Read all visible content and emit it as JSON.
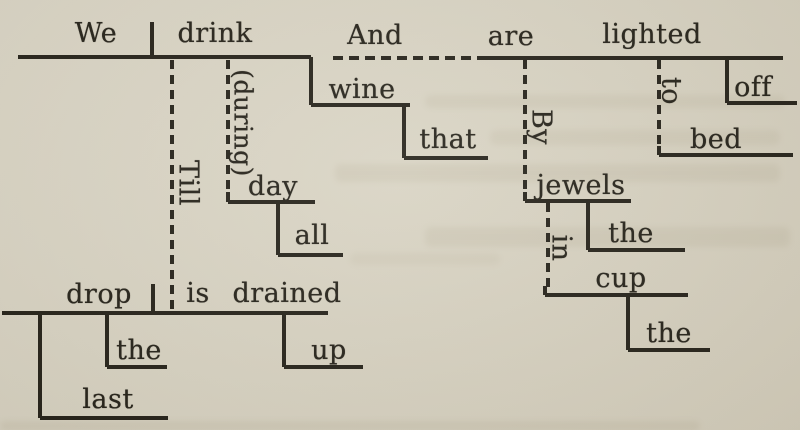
{
  "page": {
    "background": "#d8d3c3",
    "ink": "#221f17",
    "description": "Reed-Kellogg sentence diagram: We drink wine that all day (during), Till the last drop is drained up, And are lighted off to bed By the jewels in the cup."
  },
  "diagram": {
    "words": [
      {
        "id": "we",
        "text": "We",
        "x": 96,
        "y": 34,
        "rotated": false
      },
      {
        "id": "drink",
        "text": "drink",
        "x": 215,
        "y": 34,
        "rotated": false
      },
      {
        "id": "and",
        "text": "And",
        "x": 375,
        "y": 36,
        "rotated": false
      },
      {
        "id": "are",
        "text": "are",
        "x": 511,
        "y": 37,
        "rotated": false
      },
      {
        "id": "lighted",
        "text": "lighted",
        "x": 652,
        "y": 35,
        "rotated": false
      },
      {
        "id": "wine",
        "text": "wine",
        "x": 362,
        "y": 90,
        "rotated": false
      },
      {
        "id": "that",
        "text": "that",
        "x": 448,
        "y": 140,
        "rotated": false
      },
      {
        "id": "by",
        "text": "By",
        "x": 541,
        "y": 127,
        "rotated": true
      },
      {
        "id": "to",
        "text": "to",
        "x": 671,
        "y": 91,
        "rotated": true
      },
      {
        "id": "off",
        "text": "off",
        "x": 753,
        "y": 88,
        "rotated": false
      },
      {
        "id": "bed",
        "text": "bed",
        "x": 716,
        "y": 140,
        "rotated": false
      },
      {
        "id": "jewels",
        "text": "jewels",
        "x": 581,
        "y": 186,
        "rotated": false
      },
      {
        "id": "the-jewels",
        "text": "the",
        "x": 631,
        "y": 234,
        "rotated": false
      },
      {
        "id": "in",
        "text": "in",
        "x": 561,
        "y": 248,
        "rotated": true
      },
      {
        "id": "cup",
        "text": "cup",
        "x": 621,
        "y": 279,
        "rotated": false
      },
      {
        "id": "the-cup",
        "text": "the",
        "x": 669,
        "y": 334,
        "rotated": false
      },
      {
        "id": "during",
        "text": "(during)",
        "x": 243,
        "y": 123,
        "rotated": true,
        "size": 25
      },
      {
        "id": "day",
        "text": "day",
        "x": 273,
        "y": 187,
        "rotated": false
      },
      {
        "id": "all",
        "text": "all",
        "x": 312,
        "y": 236,
        "rotated": false
      },
      {
        "id": "till",
        "text": "Till",
        "x": 188,
        "y": 183,
        "rotated": true
      },
      {
        "id": "drop",
        "text": "drop",
        "x": 99,
        "y": 295,
        "rotated": false
      },
      {
        "id": "is",
        "text": "is",
        "x": 198,
        "y": 294,
        "rotated": false
      },
      {
        "id": "drained",
        "text": "drained",
        "x": 287,
        "y": 294,
        "rotated": false
      },
      {
        "id": "the-drop",
        "text": "the",
        "x": 139,
        "y": 351,
        "rotated": false
      },
      {
        "id": "up",
        "text": "up",
        "x": 329,
        "y": 351,
        "rotated": false
      },
      {
        "id": "last",
        "text": "last",
        "x": 108,
        "y": 400,
        "rotated": false
      }
    ],
    "solid_segments": [
      {
        "name": "clause1-base",
        "x1": 18,
        "y1": 57,
        "x2": 311,
        "y2": 57
      },
      {
        "name": "subject-verb-divider-1",
        "x1": 152,
        "y1": 22,
        "x2": 152,
        "y2": 57
      },
      {
        "name": "wine-object-step",
        "x1": 311,
        "y1": 57,
        "x2": 311,
        "y2": 105
      },
      {
        "name": "wine-base",
        "x1": 311,
        "y1": 105,
        "x2": 410,
        "y2": 105
      },
      {
        "name": "that-step",
        "x1": 404,
        "y1": 105,
        "x2": 404,
        "y2": 158
      },
      {
        "name": "that-base",
        "x1": 404,
        "y1": 158,
        "x2": 488,
        "y2": 158
      },
      {
        "name": "clause2-base",
        "x1": 480,
        "y1": 58,
        "x2": 783,
        "y2": 58
      },
      {
        "name": "off-step",
        "x1": 727,
        "y1": 58,
        "x2": 727,
        "y2": 103
      },
      {
        "name": "off-base",
        "x1": 727,
        "y1": 103,
        "x2": 797,
        "y2": 103
      },
      {
        "name": "bed-tick",
        "x1": 659,
        "y1": 146,
        "x2": 659,
        "y2": 155
      },
      {
        "name": "bed-base",
        "x1": 659,
        "y1": 155,
        "x2": 793,
        "y2": 155
      },
      {
        "name": "jewels-tick",
        "x1": 525,
        "y1": 192,
        "x2": 525,
        "y2": 201
      },
      {
        "name": "jewels-base",
        "x1": 525,
        "y1": 201,
        "x2": 631,
        "y2": 201
      },
      {
        "name": "jewels-the-step",
        "x1": 588,
        "y1": 201,
        "x2": 588,
        "y2": 250
      },
      {
        "name": "jewels-the-base",
        "x1": 588,
        "y1": 250,
        "x2": 685,
        "y2": 250
      },
      {
        "name": "cup-tick",
        "x1": 545,
        "y1": 286,
        "x2": 545,
        "y2": 295
      },
      {
        "name": "cup-base",
        "x1": 545,
        "y1": 295,
        "x2": 688,
        "y2": 295
      },
      {
        "name": "cup-the-step",
        "x1": 628,
        "y1": 295,
        "x2": 628,
        "y2": 350
      },
      {
        "name": "cup-the-base",
        "x1": 628,
        "y1": 350,
        "x2": 710,
        "y2": 350
      },
      {
        "name": "day-tick",
        "x1": 228,
        "y1": 192,
        "x2": 228,
        "y2": 202
      },
      {
        "name": "day-base",
        "x1": 228,
        "y1": 202,
        "x2": 315,
        "y2": 202
      },
      {
        "name": "all-step",
        "x1": 278,
        "y1": 202,
        "x2": 278,
        "y2": 255
      },
      {
        "name": "all-base",
        "x1": 278,
        "y1": 255,
        "x2": 343,
        "y2": 255
      },
      {
        "name": "clause3-base",
        "x1": 2,
        "y1": 313,
        "x2": 328,
        "y2": 313
      },
      {
        "name": "subject-verb-divider-2",
        "x1": 153,
        "y1": 284,
        "x2": 153,
        "y2": 313
      },
      {
        "name": "up-step",
        "x1": 284,
        "y1": 313,
        "x2": 284,
        "y2": 367
      },
      {
        "name": "up-base",
        "x1": 284,
        "y1": 367,
        "x2": 363,
        "y2": 367
      },
      {
        "name": "drop-the-step",
        "x1": 107,
        "y1": 313,
        "x2": 107,
        "y2": 367
      },
      {
        "name": "drop-the-base",
        "x1": 107,
        "y1": 367,
        "x2": 167,
        "y2": 367
      },
      {
        "name": "last-step",
        "x1": 40,
        "y1": 313,
        "x2": 40,
        "y2": 418
      },
      {
        "name": "last-base",
        "x1": 40,
        "y1": 418,
        "x2": 168,
        "y2": 418
      }
    ],
    "dashed_segments": [
      {
        "name": "and-conjunction-connector",
        "x1": 333,
        "y1": 58,
        "x2": 480,
        "y2": 58
      },
      {
        "name": "till-connector",
        "x1": 172,
        "y1": 60,
        "x2": 172,
        "y2": 311
      },
      {
        "name": "during-connector",
        "x1": 228,
        "y1": 60,
        "x2": 228,
        "y2": 190
      },
      {
        "name": "by-connector",
        "x1": 525,
        "y1": 60,
        "x2": 525,
        "y2": 199
      },
      {
        "name": "to-connector",
        "x1": 659,
        "y1": 60,
        "x2": 659,
        "y2": 144
      },
      {
        "name": "in-connector",
        "x1": 548,
        "y1": 203,
        "x2": 548,
        "y2": 293
      }
    ],
    "artifacts": [
      {
        "x": 425,
        "y": 95,
        "w": 360,
        "h": 13,
        "opacity": 0.1
      },
      {
        "x": 490,
        "y": 130,
        "w": 290,
        "h": 15,
        "opacity": 0.1
      },
      {
        "x": 335,
        "y": 164,
        "w": 445,
        "h": 18,
        "opacity": 0.11
      },
      {
        "x": 425,
        "y": 227,
        "w": 365,
        "h": 20,
        "opacity": 0.11
      },
      {
        "x": 350,
        "y": 253,
        "w": 150,
        "h": 12,
        "opacity": 0.08
      },
      {
        "x": 0,
        "y": 421,
        "w": 700,
        "h": 10,
        "opacity": 0.12
      }
    ]
  }
}
